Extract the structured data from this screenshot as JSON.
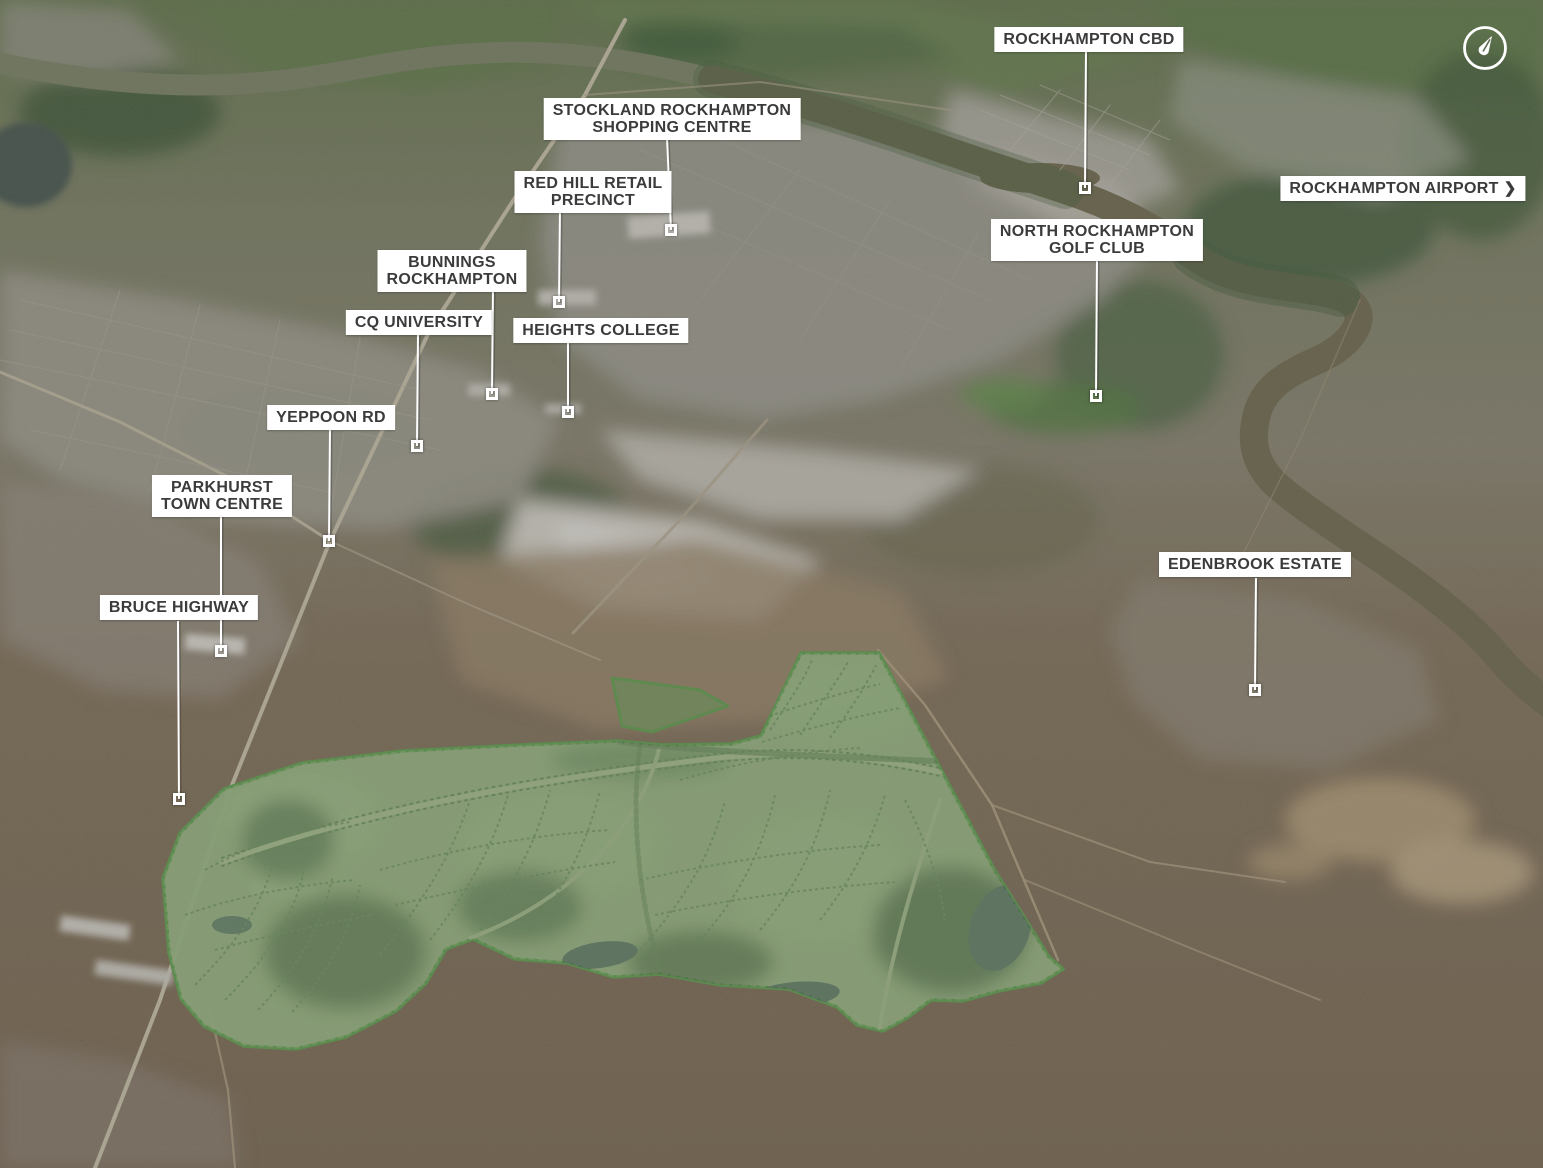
{
  "map": {
    "type": "aerial-masterplan-map",
    "compass": {
      "icon": "compass-north-icon"
    },
    "colors": {
      "estate_fill": "#9cbd85",
      "estate_outline": "#5fa24c",
      "label_bg": "#ffffff",
      "label_text": "#3b3b3b",
      "leader_line": "#ffffff"
    },
    "labels": [
      {
        "id": "rockhampton-cbd",
        "lines": [
          "ROCKHAMPTON CBD"
        ],
        "cx": 1089,
        "y": 27,
        "leader": {
          "x1": 1086,
          "y1": 52,
          "x2": 1085,
          "y2": 188
        },
        "marker": {
          "x": 1085,
          "y": 188
        }
      },
      {
        "id": "stockland-rockhampton-shopping-centre",
        "lines": [
          "STOCKLAND ROCKHAMPTON",
          "SHOPPING CENTRE"
        ],
        "cx": 672,
        "y": 98,
        "leader": {
          "x1": 667,
          "y1": 137,
          "x2": 671,
          "y2": 230
        },
        "marker": {
          "x": 671,
          "y": 230
        }
      },
      {
        "id": "red-hill-retail-precinct",
        "lines": [
          "RED HILL RETAIL",
          "PRECINCT"
        ],
        "cx": 593,
        "y": 171,
        "leader": {
          "x1": 560,
          "y1": 209,
          "x2": 559,
          "y2": 302
        },
        "marker": {
          "x": 559,
          "y": 302
        }
      },
      {
        "id": "rockhampton-airport",
        "lines": [
          "ROCKHAMPTON AIRPORT"
        ],
        "cx": 1403,
        "y": 176,
        "chevron": "❯",
        "leader": null,
        "marker": null
      },
      {
        "id": "north-rockhampton-golf-club",
        "lines": [
          "NORTH ROCKHAMPTON",
          "GOLF CLUB"
        ],
        "cx": 1097,
        "y": 219,
        "leader": {
          "x1": 1097,
          "y1": 258,
          "x2": 1096,
          "y2": 396
        },
        "marker": {
          "x": 1096,
          "y": 396
        }
      },
      {
        "id": "bunnings-rockhampton",
        "lines": [
          "BUNNINGS",
          "ROCKHAMPTON"
        ],
        "cx": 452,
        "y": 250,
        "leader": {
          "x1": 493,
          "y1": 288,
          "x2": 492,
          "y2": 394
        },
        "marker": {
          "x": 492,
          "y": 394
        }
      },
      {
        "id": "cq-university",
        "lines": [
          "CQ UNIVERSITY"
        ],
        "cx": 419,
        "y": 310,
        "leader": {
          "x1": 418,
          "y1": 335,
          "x2": 417,
          "y2": 446
        },
        "marker": {
          "x": 417,
          "y": 446
        }
      },
      {
        "id": "heights-college",
        "lines": [
          "HEIGHTS COLLEGE"
        ],
        "cx": 601,
        "y": 318,
        "leader": {
          "x1": 568,
          "y1": 343,
          "x2": 568,
          "y2": 412
        },
        "marker": {
          "x": 568,
          "y": 412
        }
      },
      {
        "id": "yeppoon-rd",
        "lines": [
          "YEPPOON RD"
        ],
        "cx": 331,
        "y": 405,
        "leader": {
          "x1": 330,
          "y1": 430,
          "x2": 329,
          "y2": 541
        },
        "marker": {
          "x": 329,
          "y": 541
        }
      },
      {
        "id": "parkhurst-town-centre",
        "lines": [
          "PARKHURST",
          "TOWN CENTRE"
        ],
        "cx": 222,
        "y": 475,
        "leader": {
          "x1": 221,
          "y1": 514,
          "x2": 221,
          "y2": 651
        },
        "marker": {
          "x": 221,
          "y": 651
        }
      },
      {
        "id": "bruce-highway",
        "lines": [
          "BRUCE HIGHWAY"
        ],
        "cx": 179,
        "y": 595,
        "leader": {
          "x1": 178,
          "y1": 621,
          "x2": 179,
          "y2": 799
        },
        "marker": {
          "x": 179,
          "y": 799
        }
      },
      {
        "id": "edenbrook-estate",
        "lines": [
          "EDENBROOK ESTATE"
        ],
        "cx": 1255,
        "y": 552,
        "leader": {
          "x1": 1256,
          "y1": 578,
          "x2": 1255,
          "y2": 690
        },
        "marker": {
          "x": 1255,
          "y": 690
        }
      }
    ]
  }
}
